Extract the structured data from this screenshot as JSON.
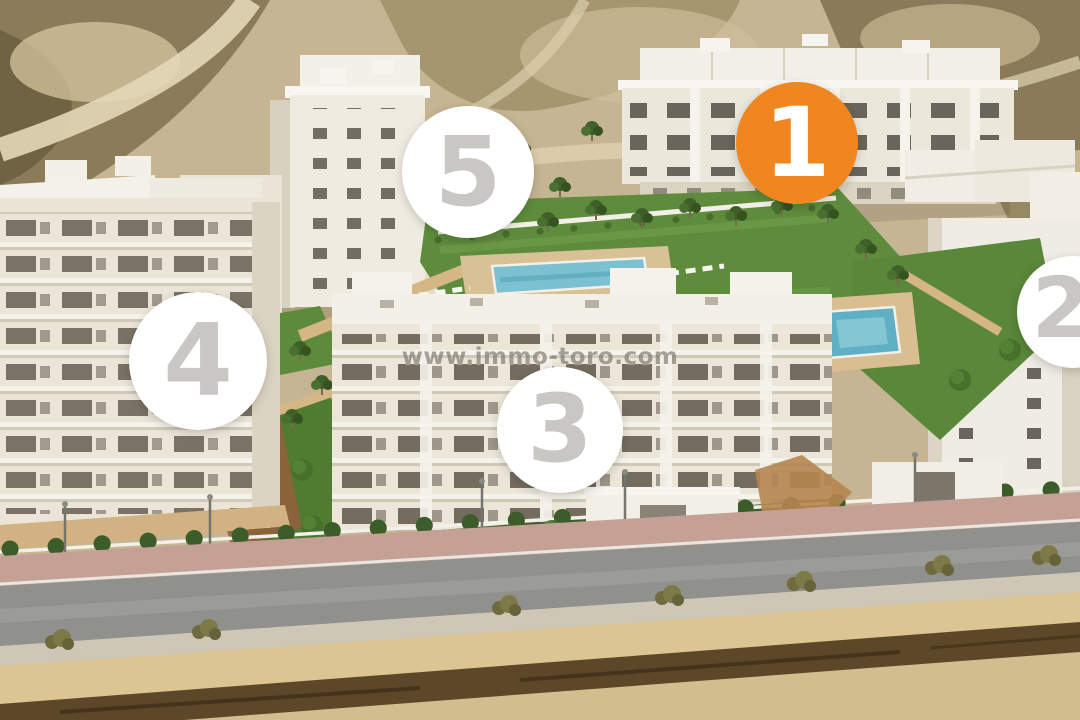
{
  "watermark": {
    "text": "www.immo-toro.com"
  },
  "markers": {
    "items": [
      {
        "label": "1",
        "highlighted": true
      },
      {
        "label": "2",
        "highlighted": false
      },
      {
        "label": "3",
        "highlighted": false
      },
      {
        "label": "4",
        "highlighted": false
      },
      {
        "label": "5",
        "highlighted": false
      }
    ]
  },
  "colors": {
    "marker_highlight_background": "#F0861F",
    "marker_highlight_number": "#FFFFFF",
    "marker_background": "#FFFFFF",
    "marker_number": "#C8C7C4"
  }
}
